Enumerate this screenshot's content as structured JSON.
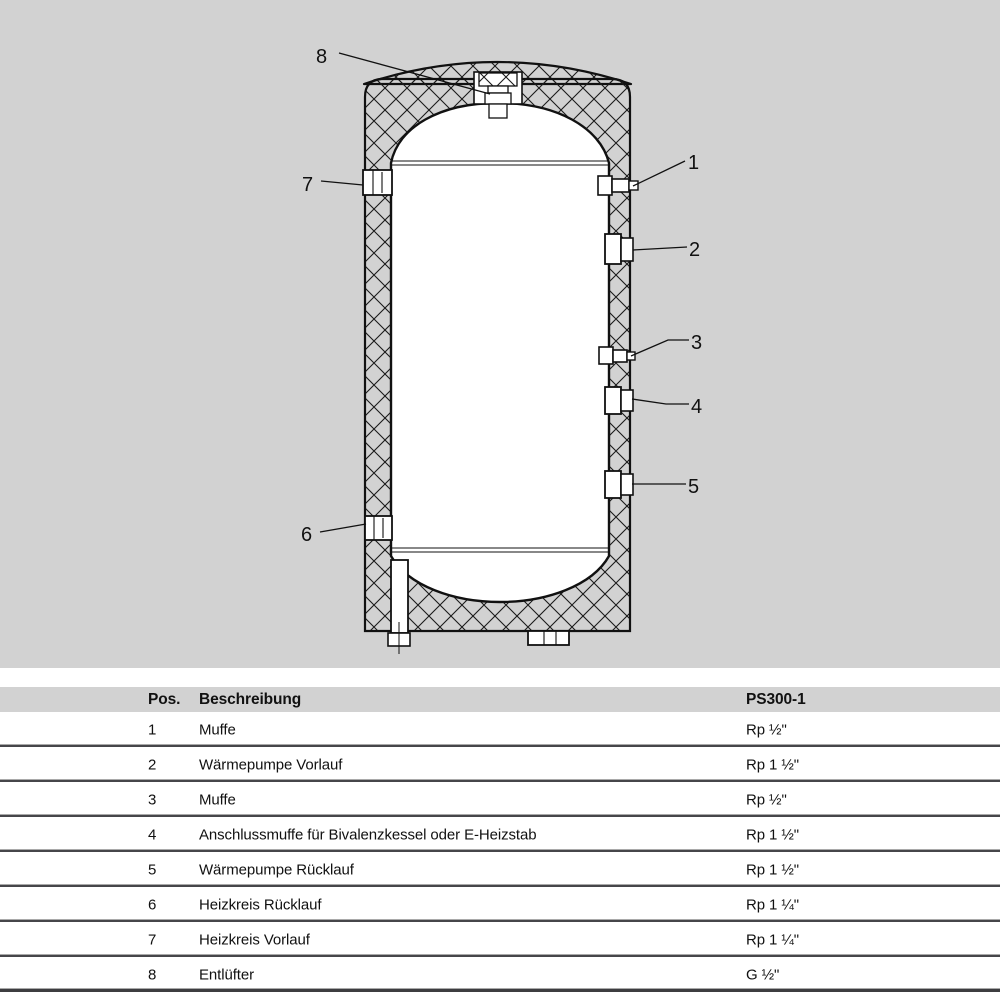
{
  "diagram": {
    "title": "Pufferspeicher Schnittzeichnung",
    "callouts": [
      "1",
      "2",
      "3",
      "4",
      "5",
      "6",
      "7",
      "8"
    ],
    "colors": {
      "background_gray": "#d2d2d2",
      "drawing_ink": "#111111",
      "vessel_fill": "#ffffff"
    }
  },
  "table": {
    "header": {
      "pos": "Pos.",
      "description": "Beschreibung",
      "model": "PS300-1"
    },
    "rows": [
      {
        "pos": "1",
        "description": "Muffe",
        "value": "Rp ½\""
      },
      {
        "pos": "2",
        "description": "Wärmepumpe Vorlauf",
        "value": "Rp 1 ½\""
      },
      {
        "pos": "3",
        "description": "Muffe",
        "value": "Rp ½\""
      },
      {
        "pos": "4",
        "description": "Anschlussmuffe für Bivalenzkessel oder E-Heizstab",
        "value": "Rp 1 ½\""
      },
      {
        "pos": "5",
        "description": "Wärmepumpe Rücklauf",
        "value": "Rp 1 ½\""
      },
      {
        "pos": "6",
        "description": "Heizkreis Rücklauf",
        "value": "Rp 1 ¼\""
      },
      {
        "pos": "7",
        "description": "Heizkreis Vorlauf",
        "value": "Rp 1 ¼\""
      },
      {
        "pos": "8",
        "description": "Entlüfter",
        "value": "G ½\""
      }
    ],
    "line_colors": {
      "light": "#a9a9a9",
      "dark": "#46464a"
    }
  }
}
